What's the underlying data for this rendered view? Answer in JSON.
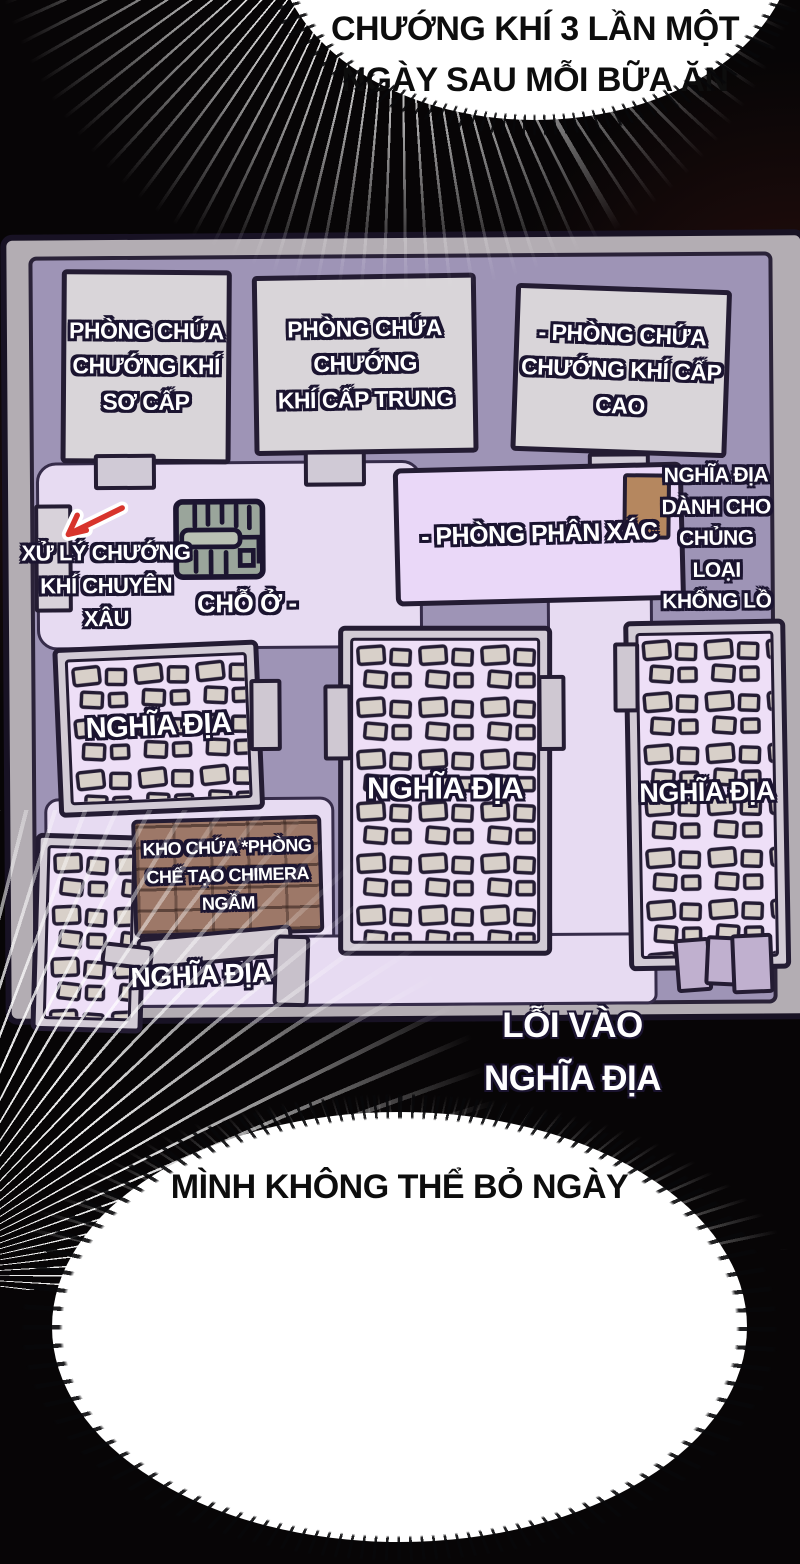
{
  "scene": {
    "top_bubble_text": "CHƯỚNG KHÍ 3 LẦN MỘT\nNGÀY SAU MỖI BỮA ĂN",
    "bottom_bubble_text": "MÌNH KHÔNG THỂ BỎ NGÀY",
    "entrance_label": "LỖI VÀO\nNGHĨA ĐỊA"
  },
  "map": {
    "rooms": {
      "miasma_primary": "PHÒNG CHỨA\nCHƯỚNG KHÍ\nSƠ CẤP",
      "miasma_mid": "PHÒNG CHỨA CHƯỚNG\nKHÍ CẤP TRUNG",
      "miasma_high": "- PHÒNG CHỨA\nCHƯỚNG KHÍ CẤP\nCAO",
      "dissection": "- PHÒNG PHÂN XÁC",
      "giant_cemetery": "NGHĨA ĐỊA\nDÀNH CHO\nCHỦNG LOẠI\nKHỔNG LỒ",
      "miasma_processing": "XỬ LÝ CHƯỚNG\nKHÍ CHUYÊN\nXÂU",
      "dwelling": "CHỖ Ở -",
      "cemetery": "NGHĨA ĐỊA",
      "chimera_workshop": "KHO CHỨA *PHÒNG\nCHẾ TẠO CHIMERA\nNGẦM"
    },
    "colors": {
      "wall": "#9e94b6",
      "corridor": "#e7dbf2",
      "room_gray": "#d9d5d9",
      "room_pink": "#eedff7",
      "outline": "#241c33",
      "chimera_brown": "#9d7868",
      "door_brown": "#b5875f",
      "arrow_red": "#d8342c"
    }
  }
}
